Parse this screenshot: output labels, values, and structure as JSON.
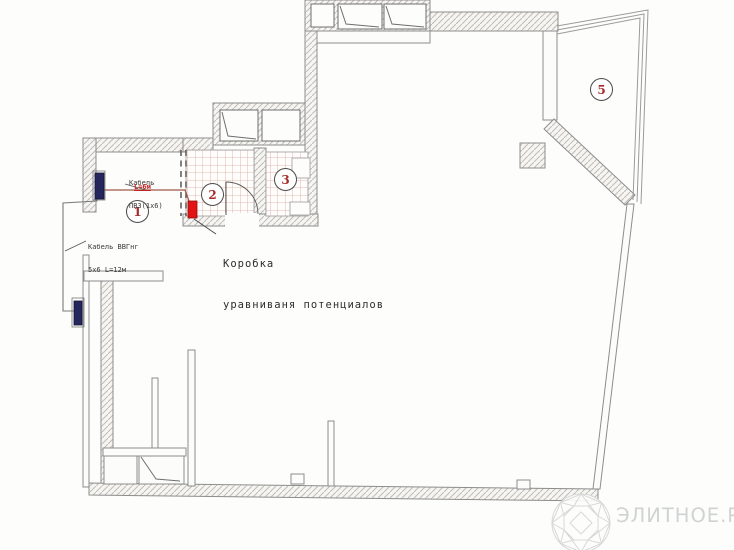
{
  "rooms": [
    {
      "number": "1"
    },
    {
      "number": "2"
    },
    {
      "number": "3"
    },
    {
      "number": "5"
    }
  ],
  "labels": {
    "cable_pv3": {
      "line1": "Кабель",
      "line2": "ПВ3(1х6)",
      "length": "L=6м"
    },
    "cable_vvg": {
      "line1": "Кабель ВВГнг",
      "line2": "5х6 L=12м"
    },
    "potential_box": {
      "line1": "Коробка",
      "line2": "уравниваня потенциалов"
    }
  },
  "watermark": {
    "text": "ЭЛИТНОЕ.РУ"
  },
  "colors": {
    "room_number": "#a62c2c",
    "cable_length_text": "#c22222",
    "equalization_box": "#e21414",
    "electric_panel": "#24265c",
    "power_wire": "#a25848",
    "tile_grid": "#d9a79e",
    "wall_outline": "#8d8d8d",
    "watermark": "#d0d3d3"
  }
}
